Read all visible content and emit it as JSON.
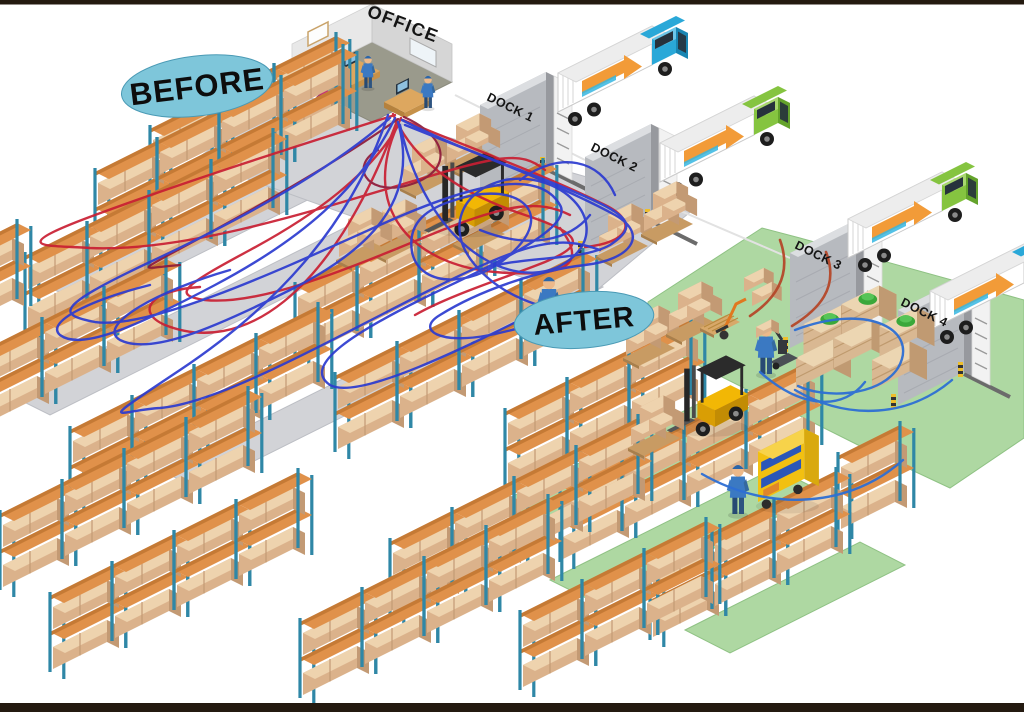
{
  "labels": {
    "before": "BEFORE",
    "after": "AFTER",
    "office": "OFFICE"
  },
  "docks": [
    "DOCK 1",
    "DOCK 2",
    "DOCK 3",
    "DOCK 4"
  ],
  "colors": {
    "label_ellipse": "#7ec6da",
    "label_ellipse_edge": "#4a9ab5",
    "floor_before": "#d2d3d7",
    "floor_before_edge": "#bcbec4",
    "floor_after": "#aed8a2",
    "floor_after_edge": "#8fc284",
    "path_red": "#c91f33",
    "path_red_dark": "#8e1a3a",
    "path_blue": "#2c3bd0",
    "path_after_blue": "#2e6fd4",
    "path_after_red": "#b5482a",
    "rack_post": "#2f87a6",
    "rack_beam": "#e0914a",
    "rack_beam_dark": "#c57a35",
    "box_front": "#dbb28b",
    "box_top": "#eed3ae",
    "box_side": "#c39a74",
    "forklift_yellow": "#f2b705",
    "truck_stripe": "#f29b38",
    "border": "#241a10"
  }
}
